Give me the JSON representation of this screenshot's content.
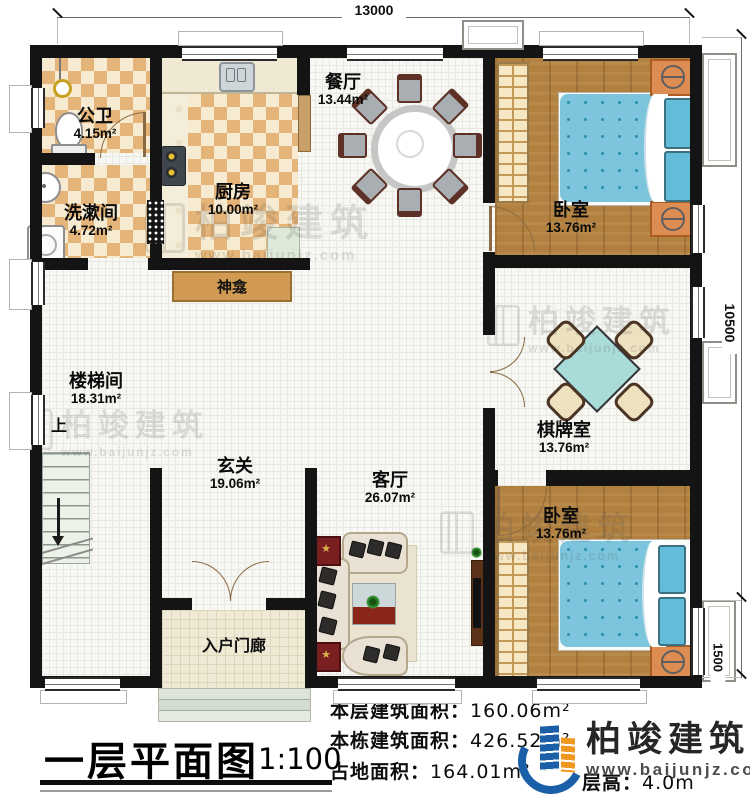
{
  "dimensions": {
    "top": "13000",
    "right": "10500",
    "right_lower": "1500"
  },
  "rooms": [
    {
      "name": "公卫",
      "area": "4.15m²"
    },
    {
      "name": "洗漱间",
      "area": "4.72m²"
    },
    {
      "name": "厨房",
      "area": "10.00m²"
    },
    {
      "name": "餐厅",
      "area": "13.44m²"
    },
    {
      "name": "卧室",
      "area": "13.76m²"
    },
    {
      "name": "棋牌室",
      "area": "13.76m²"
    },
    {
      "name": "卧室",
      "area": "13.76m²"
    },
    {
      "name": "楼梯间",
      "area": "18.31m²"
    },
    {
      "name": "玄关",
      "area": "19.06m²"
    },
    {
      "name": "客厅",
      "area": "26.07m²"
    },
    {
      "name": "入户门廊",
      "area": ""
    }
  ],
  "labels": {
    "shrine": "神龛",
    "stairs_up": "上"
  },
  "title": {
    "text": "一层平面图",
    "scale": "1:100"
  },
  "stats": [
    {
      "label": "本层建筑面积：",
      "value": "160.06m²"
    },
    {
      "label": "本栋建筑面积：",
      "value": "426.52m²"
    },
    {
      "label": "占地面积：",
      "value": "164.01m²"
    },
    {
      "label": "层高：",
      "value": "4.0m"
    }
  ],
  "logo": {
    "name": "柏竣建筑",
    "url": "www.baijunjz.com"
  },
  "watermark": {
    "name": "柏竣建筑",
    "url": "www.baijunjz.com"
  },
  "colors": {
    "wall": "#141414",
    "wood": "#b2813f",
    "checker": "#e4b478",
    "bed": "#7cc5dc",
    "logo_blue": "#1a5fa8",
    "logo_orange": "#f0971e"
  }
}
